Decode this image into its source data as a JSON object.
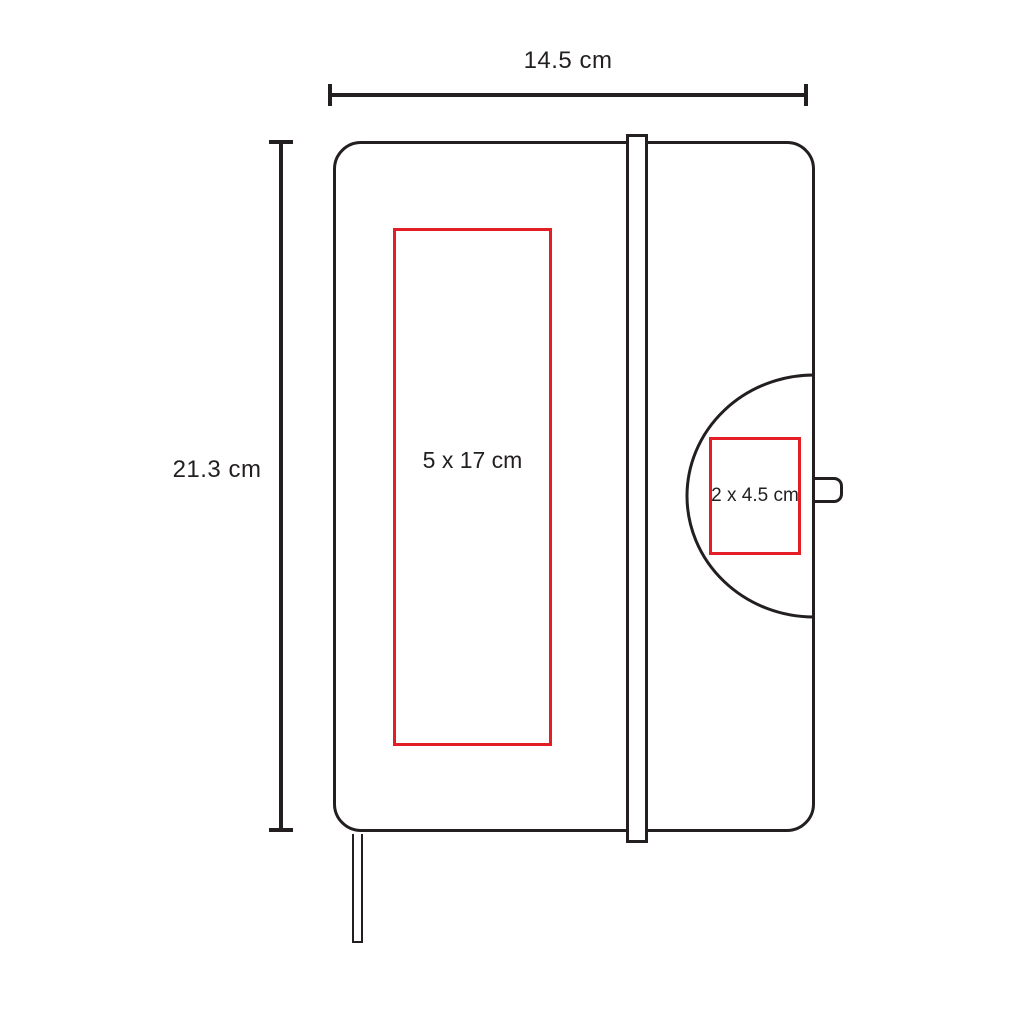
{
  "colors": {
    "background": "#ffffff",
    "line": "#231f20",
    "accent": "#e41e25"
  },
  "dimensions": {
    "width": {
      "label": "14.5 cm"
    },
    "height": {
      "label": "21.3 cm"
    }
  },
  "print_areas": {
    "front": {
      "label": "5 x 17 cm"
    },
    "flap": {
      "label": "2 x 4.5 cm"
    }
  }
}
